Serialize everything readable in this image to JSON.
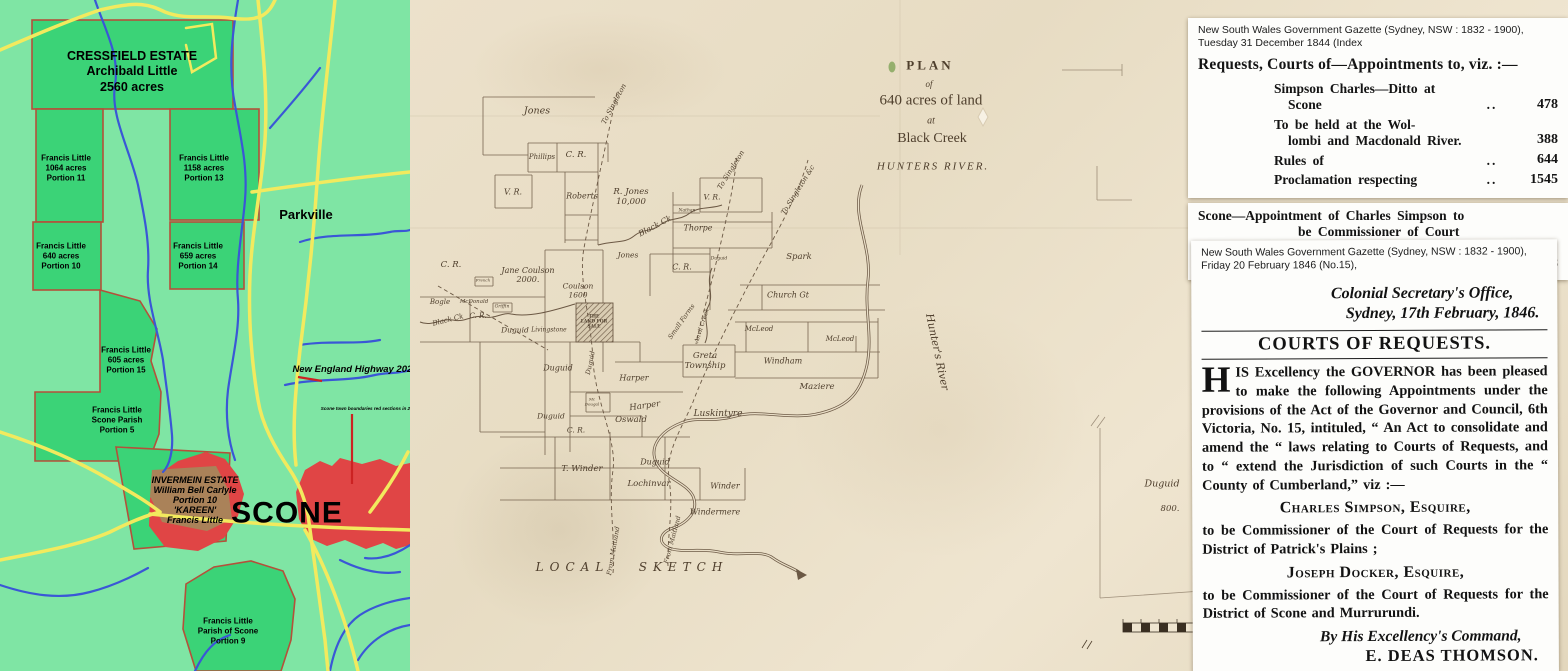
{
  "estate_map": {
    "colors": {
      "background": "#7fe5a4",
      "estate_green": "#3bd377",
      "town_red": "#e04545",
      "kareen_brown": "#aa8259",
      "road_yellow": "#f2ea5e",
      "river_blue": "#3a57d6",
      "border": "#b5503a",
      "mark_red": "#cc2222"
    },
    "cressfield_label": "CRESSFIELD ESTATE\nArchibald Little\n2560 acres",
    "portion_11": "Francis Little\n1064 acres\nPortion 11",
    "portion_13": "Francis Little\n1158 acres\nPortion 13",
    "portion_10": "Francis Little\n640 acres\nPortion 10",
    "portion_14": "Francis Little\n659 acres\nPortion 14",
    "portion_15": "Francis Little\n605 acres\nPortion 15",
    "portion_5": "Francis Little\nScone Parish\nPortion 5",
    "portion_9": "Francis Little\nParish of Scone\nPortion 9",
    "parkville": "Parkville",
    "highway": "New England Highway 2022",
    "boundary_note": "Scone town boundaries red sections in 202",
    "scone": "SCONE",
    "invermein": "INVERMEIN ESTATE\nWilliam Bell Carlyle\nPortion 10\n'KAREEN'\nFrancis Little"
  },
  "plan": {
    "labels": [
      {
        "n": "plan-title-plan",
        "t": "PLAN",
        "x": 520,
        "y": 66,
        "s": 13,
        "w": 3,
        "c": "ti b"
      },
      {
        "n": "plan-title-of",
        "t": "of",
        "x": 519,
        "y": 84,
        "s": 9,
        "c": "ti it"
      },
      {
        "n": "plan-title-acres",
        "t": "640 acres of land",
        "x": 521,
        "y": 101,
        "s": 15,
        "c": "ti"
      },
      {
        "n": "plan-title-at",
        "t": "at",
        "x": 521,
        "y": 121,
        "s": 10,
        "c": "ti it"
      },
      {
        "n": "plan-title-black-creek",
        "t": "Black Creek",
        "x": 522,
        "y": 139,
        "s": 14,
        "c": "ti"
      },
      {
        "n": "plan-title-hunters-river",
        "t": "HUNTERS RIVER.",
        "x": 523,
        "y": 167,
        "s": 11,
        "w": 2,
        "c": "ti it"
      },
      {
        "n": "label-jones-1",
        "t": "Jones",
        "x": 127,
        "y": 112,
        "s": 9.5,
        "c": "it"
      },
      {
        "n": "label-phillips",
        "t": "Phillips",
        "x": 132,
        "y": 157,
        "s": 7,
        "c": "it"
      },
      {
        "n": "label-cr-1",
        "t": "C. R.",
        "x": 166,
        "y": 156,
        "s": 8.5,
        "c": "it"
      },
      {
        "n": "label-vr-1",
        "t": "V. R.",
        "x": 103,
        "y": 192,
        "s": 8,
        "c": "it"
      },
      {
        "n": "label-roberts",
        "t": "Roberts",
        "x": 172,
        "y": 196,
        "s": 8,
        "c": "it"
      },
      {
        "n": "label-r-jones",
        "t": "R. Jones\n10,000",
        "x": 221,
        "y": 198,
        "s": 8.5,
        "c": "it"
      },
      {
        "n": "label-to-singleton-1",
        "t": "To Singleton",
        "x": 204,
        "y": 104,
        "s": 7,
        "r": -62,
        "c": "it"
      },
      {
        "n": "label-to-singleton-2",
        "t": "To Singleton",
        "x": 321,
        "y": 170,
        "s": 7,
        "r": -58,
        "c": "it"
      },
      {
        "n": "label-to-singleton-3",
        "t": "To Singleton &c",
        "x": 388,
        "y": 190,
        "s": 7,
        "r": -58,
        "c": "it"
      },
      {
        "n": "label-black-ck-1",
        "t": "Black Ck",
        "x": 245,
        "y": 226,
        "s": 8,
        "r": -28,
        "c": "it"
      },
      {
        "n": "label-nathan",
        "t": "Nathan",
        "x": 277,
        "y": 211,
        "s": 4.5,
        "c": "it"
      },
      {
        "n": "label-thorpe",
        "t": "Thorpe",
        "x": 288,
        "y": 228,
        "s": 8,
        "c": "it"
      },
      {
        "n": "label-vr-2",
        "t": "V. R.",
        "x": 302,
        "y": 198,
        "s": 7.5,
        "c": "it"
      },
      {
        "n": "label-jones-2",
        "t": "Jones",
        "x": 218,
        "y": 256,
        "s": 7.5,
        "c": "it"
      },
      {
        "n": "label-cr-2",
        "t": "C. R.",
        "x": 272,
        "y": 267,
        "s": 8,
        "c": "it"
      },
      {
        "n": "label-duguid-small",
        "t": "Duguid",
        "x": 309,
        "y": 259,
        "s": 4.5,
        "c": "it"
      },
      {
        "n": "label-spark",
        "t": "Spark",
        "x": 389,
        "y": 258,
        "s": 8.5,
        "c": "it"
      },
      {
        "n": "label-church-gt",
        "t": "Church Gt",
        "x": 378,
        "y": 295,
        "s": 8,
        "c": "it"
      },
      {
        "n": "label-mcleod-1",
        "t": "McLeod",
        "x": 349,
        "y": 329,
        "s": 7,
        "c": "it"
      },
      {
        "n": "label-mcleod-2",
        "t": "McLeod",
        "x": 430,
        "y": 339,
        "s": 7,
        "c": "it"
      },
      {
        "n": "label-windham",
        "t": "Windham",
        "x": 373,
        "y": 361,
        "s": 8,
        "c": "it"
      },
      {
        "n": "label-maziere",
        "t": "Maziere",
        "x": 407,
        "y": 388,
        "s": 8.5,
        "c": "it"
      },
      {
        "n": "label-hunters-river",
        "t": "Hunter's River",
        "x": 527,
        "y": 352,
        "s": 10.5,
        "r": 78,
        "c": "it"
      },
      {
        "n": "label-greta-township",
        "t": "Greta\nTownship",
        "x": 295,
        "y": 362,
        "s": 8.5,
        "c": "it"
      },
      {
        "n": "label-small-farms",
        "t": "Small Farms",
        "x": 272,
        "y": 322,
        "s": 6.5,
        "r": -55,
        "c": "it"
      },
      {
        "n": "label-anvil-creek",
        "t": "Anvil Creek",
        "x": 293,
        "y": 326,
        "s": 6,
        "r": -72,
        "c": "it"
      },
      {
        "n": "label-jane-coulson",
        "t": "Jane Coulson\n2000.",
        "x": 118,
        "y": 275,
        "s": 8,
        "c": "it"
      },
      {
        "n": "label-coulson",
        "t": "Coulson\n1600",
        "x": 168,
        "y": 291,
        "s": 7.5,
        "c": "it"
      },
      {
        "n": "label-french",
        "t": "French",
        "x": 73,
        "y": 281,
        "s": 4,
        "c": "it"
      },
      {
        "n": "label-bogle",
        "t": "Bogle",
        "x": 30,
        "y": 302,
        "s": 7,
        "c": "it"
      },
      {
        "n": "label-mcdonald",
        "t": "McDonald",
        "x": 64,
        "y": 302,
        "s": 5.5,
        "c": "it"
      },
      {
        "n": "label-griffin",
        "t": "Griffin",
        "x": 92,
        "y": 307,
        "s": 4.5,
        "c": "it"
      },
      {
        "n": "label-black-ck-2",
        "t": "Black Ck",
        "x": 38,
        "y": 320,
        "s": 7,
        "r": -14,
        "c": "it"
      },
      {
        "n": "label-duguid-1",
        "t": "Duguid",
        "x": 105,
        "y": 331,
        "s": 7.5,
        "c": "it"
      },
      {
        "n": "label-livingstone",
        "t": "Livingstone",
        "x": 139,
        "y": 331,
        "s": 6,
        "c": "it"
      },
      {
        "n": "label-land-for-sale",
        "t": "THE\nLAND FOR\nSALE",
        "x": 184,
        "y": 322,
        "s": 4.4,
        "c": "b"
      },
      {
        "n": "label-duguid-vertical",
        "t": "Duguid",
        "x": 181,
        "y": 363,
        "s": 6.5,
        "r": -78,
        "c": "it"
      },
      {
        "n": "label-duguid-2",
        "t": "Duguid",
        "x": 148,
        "y": 368,
        "s": 8,
        "c": "it"
      },
      {
        "n": "label-harper-1",
        "t": "Harper",
        "x": 224,
        "y": 378,
        "s": 8,
        "c": "it"
      },
      {
        "n": "label-harper-2",
        "t": "Harper",
        "x": 235,
        "y": 407,
        "s": 8.5,
        "r": -8,
        "c": "it"
      },
      {
        "n": "label-oswald",
        "t": "Oswald",
        "x": 221,
        "y": 421,
        "s": 8.5,
        "c": "it"
      },
      {
        "n": "label-mcdougal",
        "t": "Mc\nDougal",
        "x": 182,
        "y": 402,
        "s": 4,
        "c": "it"
      },
      {
        "n": "label-cr-3",
        "t": "C. R.",
        "x": 166,
        "y": 431,
        "s": 7.5,
        "c": "it"
      },
      {
        "n": "label-cr-4",
        "t": "C. R.",
        "x": 41,
        "y": 266,
        "s": 8.5,
        "c": "it"
      },
      {
        "n": "label-cr-5",
        "t": "C. R.",
        "x": 68,
        "y": 316,
        "s": 7,
        "c": "it"
      },
      {
        "n": "label-duguid-3",
        "t": "Duguid",
        "x": 141,
        "y": 417,
        "s": 7.5,
        "c": "it"
      },
      {
        "n": "label-luskintyre",
        "t": "Luskintyre",
        "x": 308,
        "y": 414,
        "s": 9,
        "c": "it"
      },
      {
        "n": "label-t-winder",
        "t": "T. Winder",
        "x": 172,
        "y": 470,
        "s": 8.5,
        "c": "it"
      },
      {
        "n": "label-duguid-4",
        "t": "Duguid",
        "x": 245,
        "y": 462,
        "s": 8,
        "c": "it"
      },
      {
        "n": "label-lochinvar",
        "t": "Lochinvar",
        "x": 239,
        "y": 485,
        "s": 8.5,
        "c": "it"
      },
      {
        "n": "label-winder",
        "t": "Winder",
        "x": 315,
        "y": 486,
        "s": 8,
        "c": "it"
      },
      {
        "n": "label-windermere",
        "t": "Windermere",
        "x": 305,
        "y": 512,
        "s": 8,
        "c": "it"
      },
      {
        "n": "label-from-maitland-1",
        "t": "From Maitland",
        "x": 204,
        "y": 551,
        "s": 6.5,
        "r": -80,
        "c": "it"
      },
      {
        "n": "label-from-maitland-2",
        "t": "From Maitland",
        "x": 263,
        "y": 540,
        "s": 6.5,
        "r": -75,
        "c": "it"
      },
      {
        "n": "label-local-sketch",
        "t": "LOCAL   SKETCH",
        "x": 222,
        "y": 568,
        "s": 12,
        "w": 6,
        "c": "it"
      },
      {
        "n": "label-duguid-800",
        "t": "Duguid",
        "x": 752,
        "y": 485,
        "s": 9.5,
        "c": "it"
      },
      {
        "n": "label-800-acres",
        "t": "800.",
        "x": 760,
        "y": 510,
        "s": 8.5,
        "c": "it"
      }
    ]
  },
  "gazette_index": {
    "source_line1": "New South Wales Government Gazette (Sydney, NSW : 1832 - 1900),",
    "source_line2": "Tuesday 31 December 1844 (Index",
    "heading": "Requests, Courts of—Appointments to, viz. :—",
    "entries": [
      {
        "lines": [
          "Simpson Charles—Ditto at",
          "Scone"
        ],
        "leader": "..",
        "page": "478"
      },
      {
        "lines": [
          "To be held at the Wol-",
          "lombi and Macdonald River."
        ],
        "leader": "",
        "page": "388"
      },
      {
        "lines": [
          "Rules of"
        ],
        "leader": "..",
        "page": "644"
      },
      {
        "lines": [
          "Proclamation respecting"
        ],
        "leader": "..",
        "page": "1545"
      }
    ],
    "footer_entry": {
      "lines": [
        "Scone—Appointment of Charles Simpson to",
        "be Commissioner of Court of",
        "Requests"
      ],
      "leader": "..",
      "page": "478"
    }
  },
  "gazette_notice": {
    "source_line1": "New South Wales Government Gazette (Sydney, NSW : 1832 - 1900),",
    "source_line2": "Friday 20 February 1846 (No.15),",
    "office_line1": "Colonial Secretary's Office,",
    "office_line2": "Sydney, 17th February, 1846.",
    "heading": "COURTS OF REQUESTS.",
    "dropcap": "H",
    "body": "IS Excellency the GOVERNOR has been pleased to make the following Appointments under the provisions of the Act of the Governor and Council, 6th Victoria, No. 15, intituled, “ An Act to consolidate and amend the “ laws relating to Courts of Requests, and to “ extend the Jurisdiction of such Courts in the “ County of Cumberland,” viz :—",
    "name1": "Charles Simpson, Esquire,",
    "para1": "to be Commissioner of the Court of Requests for the District of Patrick's Plains ;",
    "name2": "Joseph Docker, Esquire,",
    "para2": "to be Commissioner of the Court of Requests for the District of Scone and Murrurundi.",
    "command": "By His Excellency's Command,",
    "signature": "E. DEAS THOMSON."
  }
}
